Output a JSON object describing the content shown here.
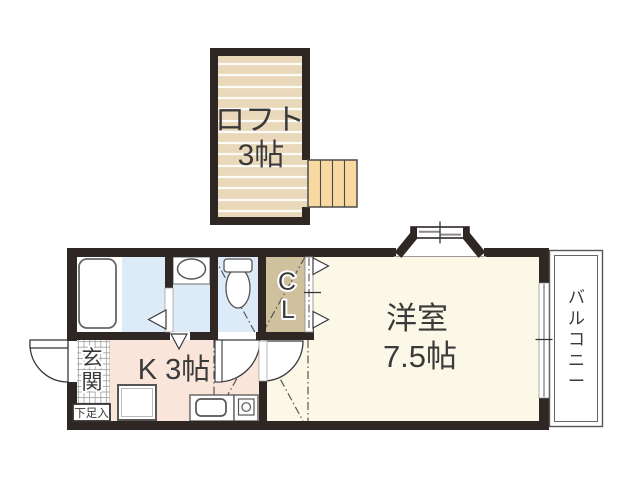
{
  "plan_title": "1K loft apartment floor plan",
  "rooms": {
    "loft": {
      "name": "ロフト",
      "size": "3帖"
    },
    "kitchen": {
      "label": "K 3帖"
    },
    "western_room": {
      "name": "洋室",
      "size": "7.5帖"
    },
    "closet": {
      "char1": "C",
      "char2": "L"
    },
    "entrance": {
      "char1": "玄",
      "char2": "関"
    },
    "shoe_cabinet": {
      "label": "下足入"
    },
    "balcony": {
      "chars": [
        "バ",
        "ル",
        "コ",
        "ニ",
        "ー"
      ]
    }
  },
  "colors": {
    "wall": "#2e2724",
    "loft_floor": "#ead8bb",
    "stairs": "#f8d9a1",
    "closet_floor": "#cfc19e",
    "wet_area_floor": "#dcebf7",
    "kitchen_floor": "#f9e5da",
    "room_floor": "#fcf8e7",
    "balcony_line": "#555555",
    "text": "#3a3a3a"
  }
}
